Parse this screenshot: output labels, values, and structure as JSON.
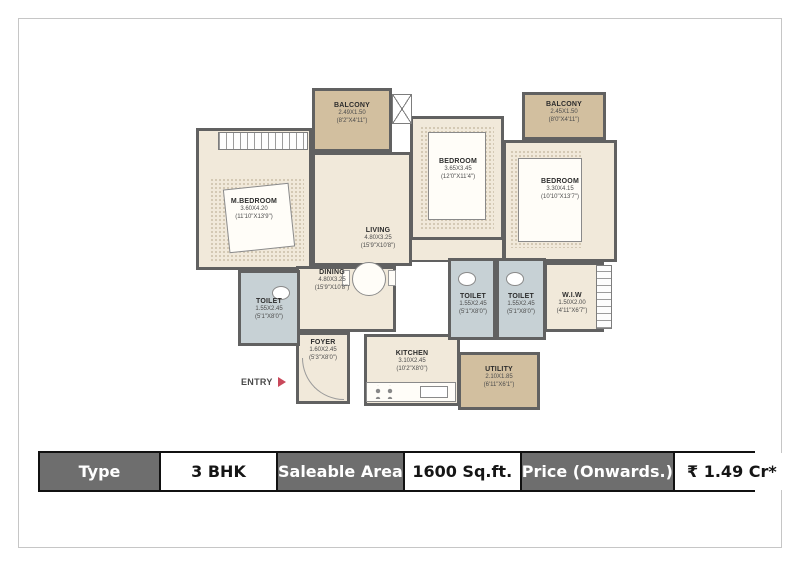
{
  "theme": {
    "wall": "#616161",
    "floor": "#f1e9da",
    "balcony": "#d2bf9f",
    "toilet": "#c7d1d5",
    "frame": "#c6c6c6",
    "header_bg": "#6e6e6e",
    "header_fg": "#ffffff",
    "table_border": "#111111",
    "entry_arrow": "#c9485b"
  },
  "plan": {
    "entry_label": "ENTRY",
    "rooms": {
      "balcony_left": {
        "name": "BALCONY",
        "dim_m": "2.49X1.50",
        "dim_ft": "(8'2\"X4'11\")"
      },
      "balcony_right": {
        "name": "BALCONY",
        "dim_m": "2.45X1.50",
        "dim_ft": "(8'0\"X4'11\")"
      },
      "m_bedroom": {
        "name": "M.BEDROOM",
        "dim_m": "3.60X4.20",
        "dim_ft": "(11'10\"X13'9\")"
      },
      "living": {
        "name": "LIVING",
        "dim_m": "4.80X3.25",
        "dim_ft": "(15'9\"X10'8\")"
      },
      "bedroom_mid": {
        "name": "BEDROOM",
        "dim_m": "3.65X3.45",
        "dim_ft": "(12'0\"X11'4\")"
      },
      "bedroom_right": {
        "name": "BEDROOM",
        "dim_m": "3.30X4.15",
        "dim_ft": "(10'10\"X13'7\")"
      },
      "dining": {
        "name": "DINING",
        "dim_m": "4.80X3.25",
        "dim_ft": "(15'9\"X10'8\")"
      },
      "toilet_left": {
        "name": "TOILET",
        "dim_m": "1.55X2.45",
        "dim_ft": "(5'1\"X8'0\")"
      },
      "toilet_mid_1": {
        "name": "TOILET",
        "dim_m": "1.55X2.45",
        "dim_ft": "(5'1\"X8'0\")"
      },
      "toilet_mid_2": {
        "name": "TOILET",
        "dim_m": "1.55X2.45",
        "dim_ft": "(5'1\"X8'0\")"
      },
      "wiw": {
        "name": "W.I.W",
        "dim_m": "1.50X2.00",
        "dim_ft": "(4'11\"X6'7\")"
      },
      "foyer": {
        "name": "FOYER",
        "dim_m": "1.60X2.45",
        "dim_ft": "(5'3\"X8'0\")"
      },
      "kitchen": {
        "name": "KITCHEN",
        "dim_m": "3.10X2.45",
        "dim_ft": "(10'2\"X8'0\")"
      },
      "utility": {
        "name": "UTILITY",
        "dim_m": "2.10X1.85",
        "dim_ft": "(6'11\"X6'1\")"
      }
    }
  },
  "spec_table": {
    "cells": [
      {
        "label": "Type",
        "kind": "header"
      },
      {
        "label": "3 BHK",
        "kind": "value"
      },
      {
        "label": "Saleable Area",
        "kind": "header"
      },
      {
        "label": "1600 Sq.ft.",
        "kind": "value"
      },
      {
        "label": "Price (Onwards.)",
        "kind": "header"
      },
      {
        "label": "₹ 1.49 Cr*",
        "kind": "value"
      }
    ]
  }
}
